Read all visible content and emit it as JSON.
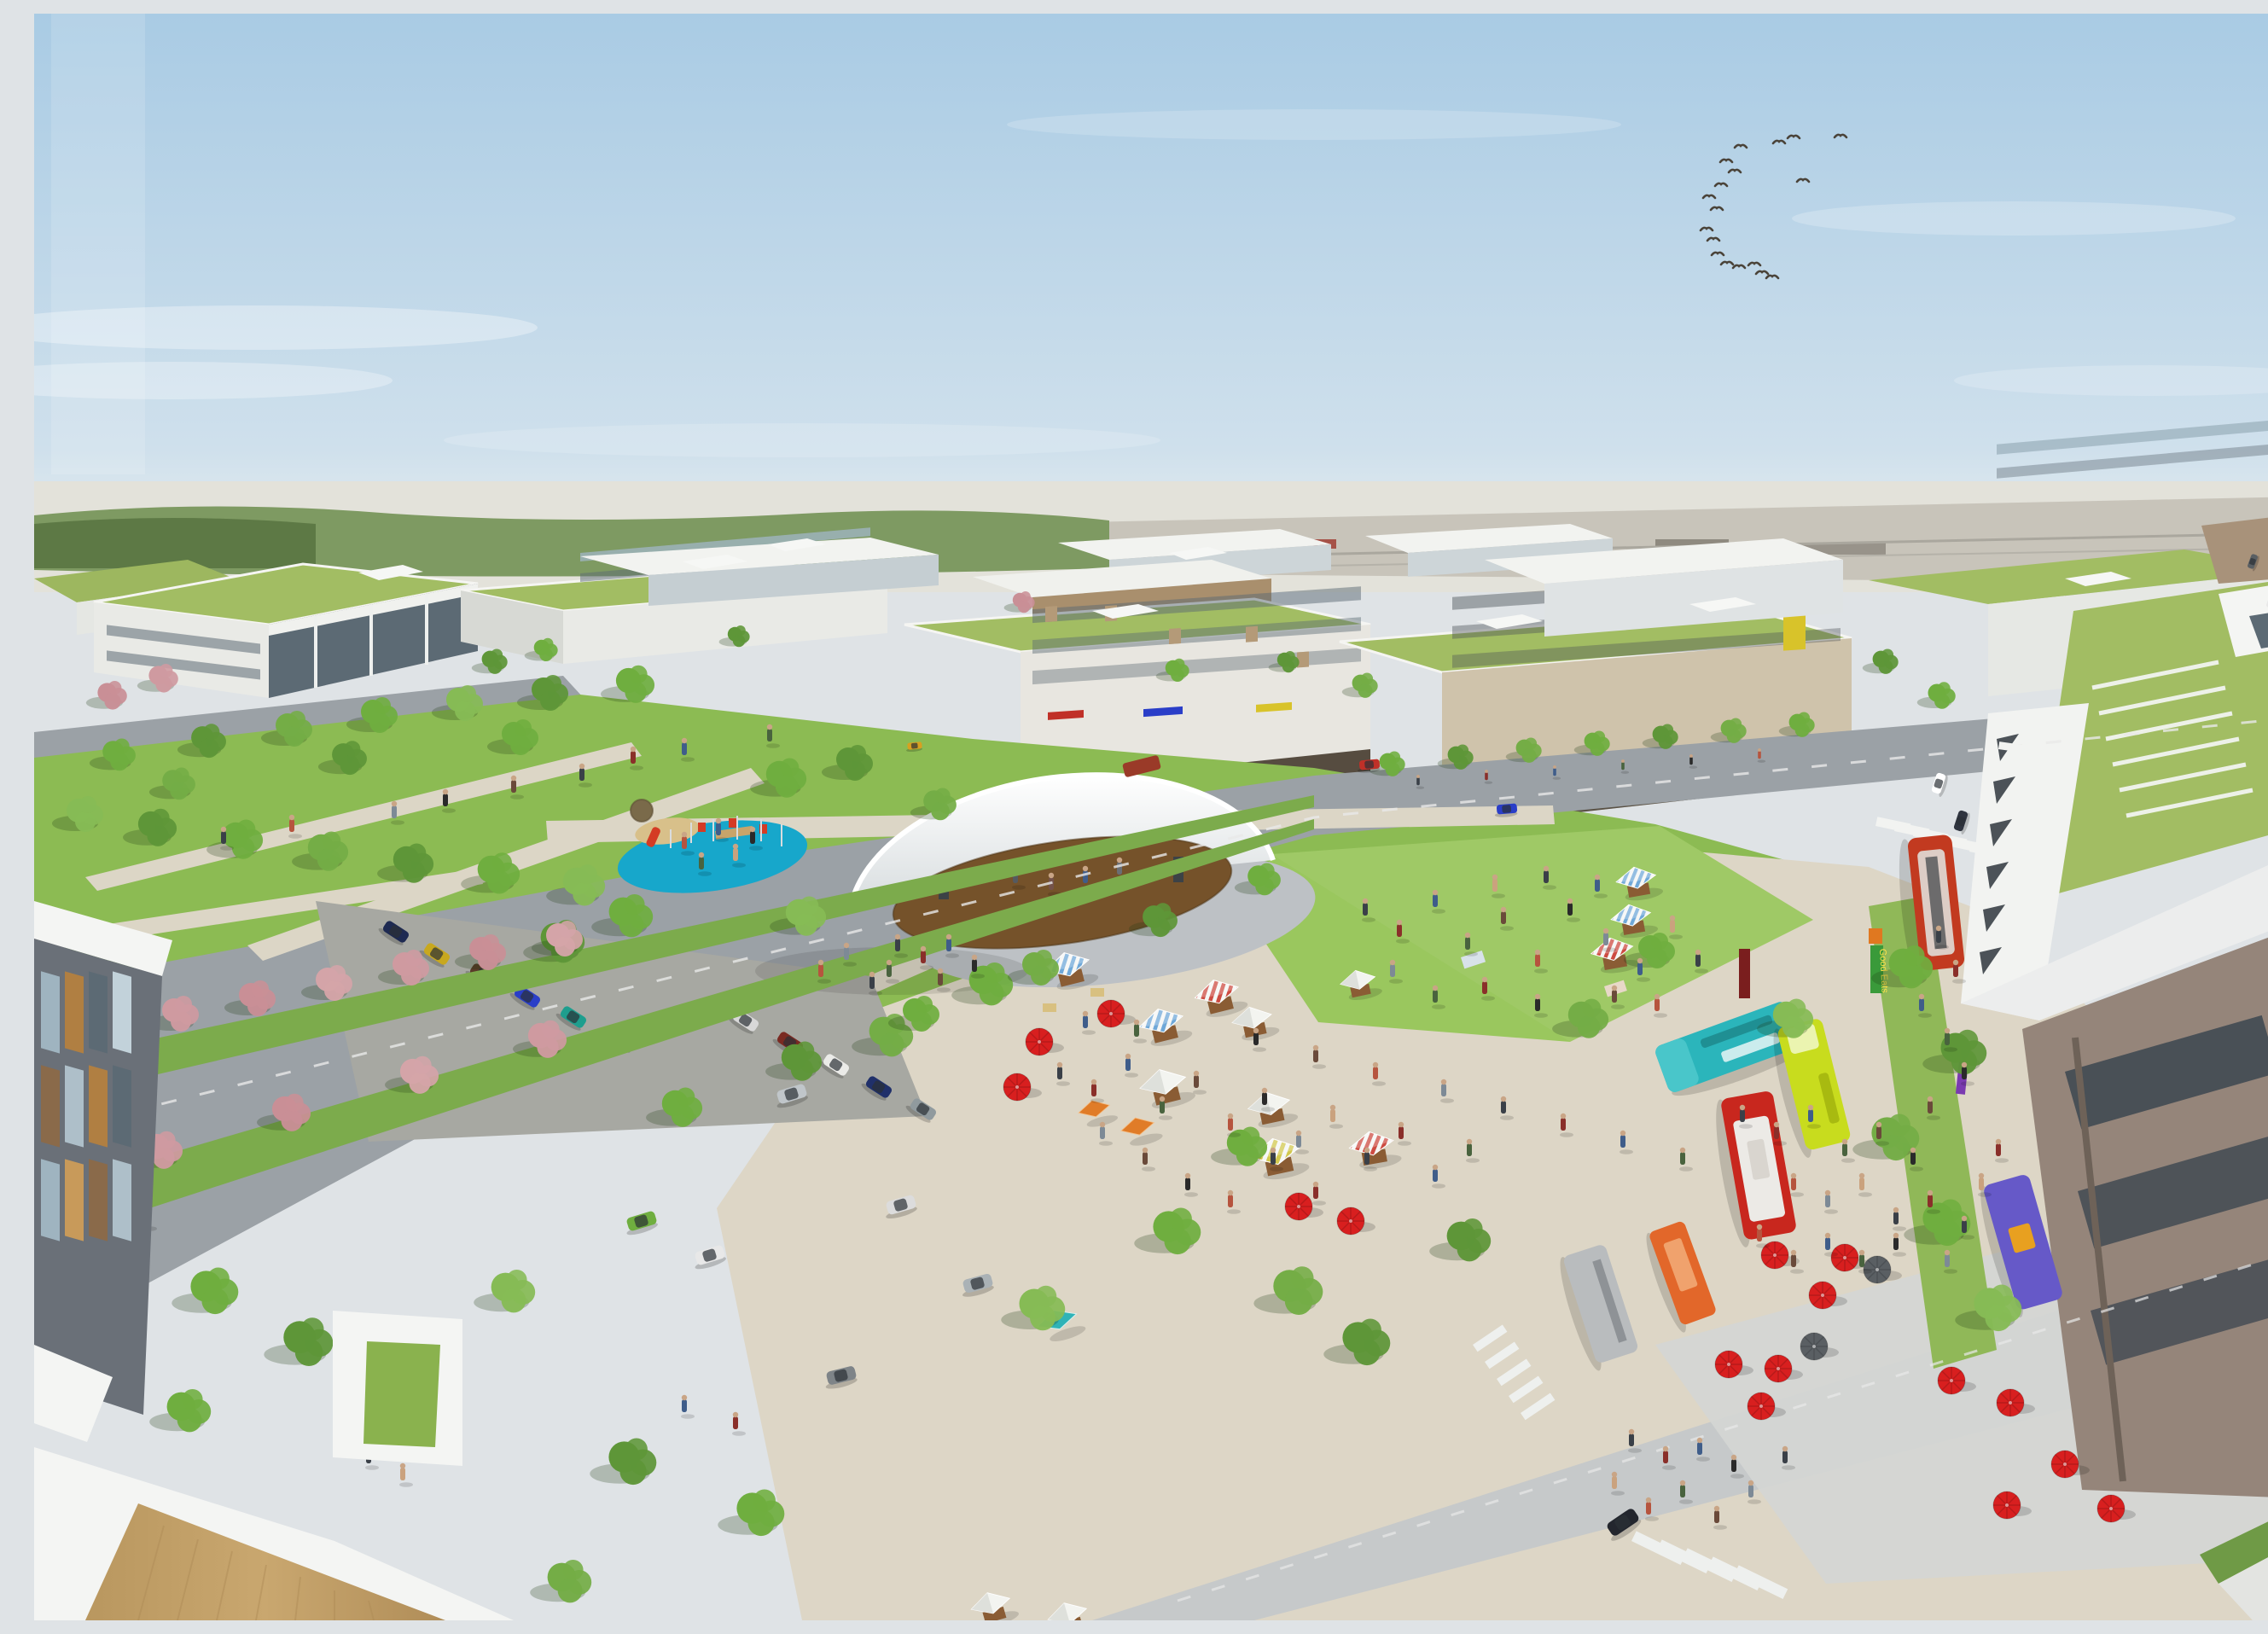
{
  "image": {
    "kind": "architectural-aerial-rendering",
    "title": "Mixed-use town center masterplan — bird's-eye rendering",
    "description": "Aerial rendering of a new mixed-use district on a sunny day: a central green with a white fabric bandshell and wooden stage, a blue-surfaced playground with red play equipment, a farmers market of striped canopy stalls, colorful food trucks and red cafe umbrellas on a paved plaza, crowds of people, tree-lined boulevards with planted medians and pink flowering trees, 3-4 story buildings with extensive green roofs and ground-floor retail, a brick residential tower with a large green roof at right, white rooftop terraces in the foreground, and a distant airfield on the hazy horizon beneath a pale blue sky with a flock of geese."
  },
  "sky": {
    "top_color": "#a9cbe4",
    "horizon_color": "#eaf0f1",
    "clouds": "thin white wisps",
    "birds": {
      "kind": "goose flock",
      "count": 18,
      "color": "#4a4339"
    }
  },
  "background": {
    "airfield_present": true,
    "tarmac_color": "#c6c2b8",
    "treeline_color": "#7e9a62"
  },
  "district": {
    "green_roofs_color": "#a2bd63",
    "building_palette": {
      "white": "#f0f1ee",
      "glass": "#9fb4c0",
      "dark_glass": "#5c6a74",
      "beige": "#cfc3ab",
      "wood_infill": "#b49a78",
      "brick": "#95857a",
      "yellow_accent": "#d8c32a"
    },
    "retail_awning_colors": [
      "#c03028",
      "#2a3ec8",
      "#d8c32a"
    ]
  },
  "park": {
    "lawn_color": "#8cbb53",
    "lawn_light": "#9ac75e",
    "path_color": "#dcd6c6",
    "bandshell": {
      "canopy_color": "#f6f7f7",
      "stage_wood": "#75522a",
      "gravel": "#bdc1c5"
    },
    "playground": {
      "surface": "#17a7cb",
      "equipment": "#d43b24",
      "sand": "#d8c08a"
    }
  },
  "market": {
    "tent_count": 17,
    "tent_stripe_colors": {
      "blue": "#6fa8d8",
      "red": "#cd4b41",
      "yellow": "#d2c84e",
      "white": "#f3f4f0",
      "orange": "#e07c28",
      "teal": "#2fb3b7"
    },
    "stall_wood": "#8a5c34",
    "banner_text": "Good Eats",
    "umbrellas": {
      "color": "#d81f1f",
      "count": 16
    }
  },
  "vehicles": {
    "food_trucks": [
      {
        "name": "teal-truck",
        "color": "#2bb5bb"
      },
      {
        "name": "lime-truck",
        "color": "#c8dc1e"
      },
      {
        "name": "red-white-truck",
        "color": "#c8271e"
      },
      {
        "name": "purple-truck",
        "color": "#6659c8"
      },
      {
        "name": "orange-trailer",
        "color": "#e2672a"
      },
      {
        "name": "silver-trailer",
        "color": "#b9bcbe"
      }
    ],
    "bus_color": "#c23a20",
    "street_car_colors": [
      "#1e2a52",
      "#c8a81e",
      "#5a3a28",
      "#2a3ec8",
      "#1e9e8e",
      "#d8d8d8",
      "#7a2a22",
      "#6fae3f",
      "#909a9e",
      "#2b3036"
    ]
  },
  "streets": {
    "asphalt": "#9ba1a6",
    "concrete": "#c6c9ca",
    "plaza_paving": "#ddd6c6",
    "median_green": "#7cab4c",
    "crosswalk_count": 4,
    "flowering_tree_color": "#cf9aa0",
    "street_tree_color": "#6fae3f"
  },
  "foreground": {
    "roof_white": "#f4f5f3",
    "deck_wood": "#c9a76f",
    "glass_building_panel_colors": [
      "#b07f42",
      "#9fb4c0",
      "#5c6a74"
    ]
  }
}
